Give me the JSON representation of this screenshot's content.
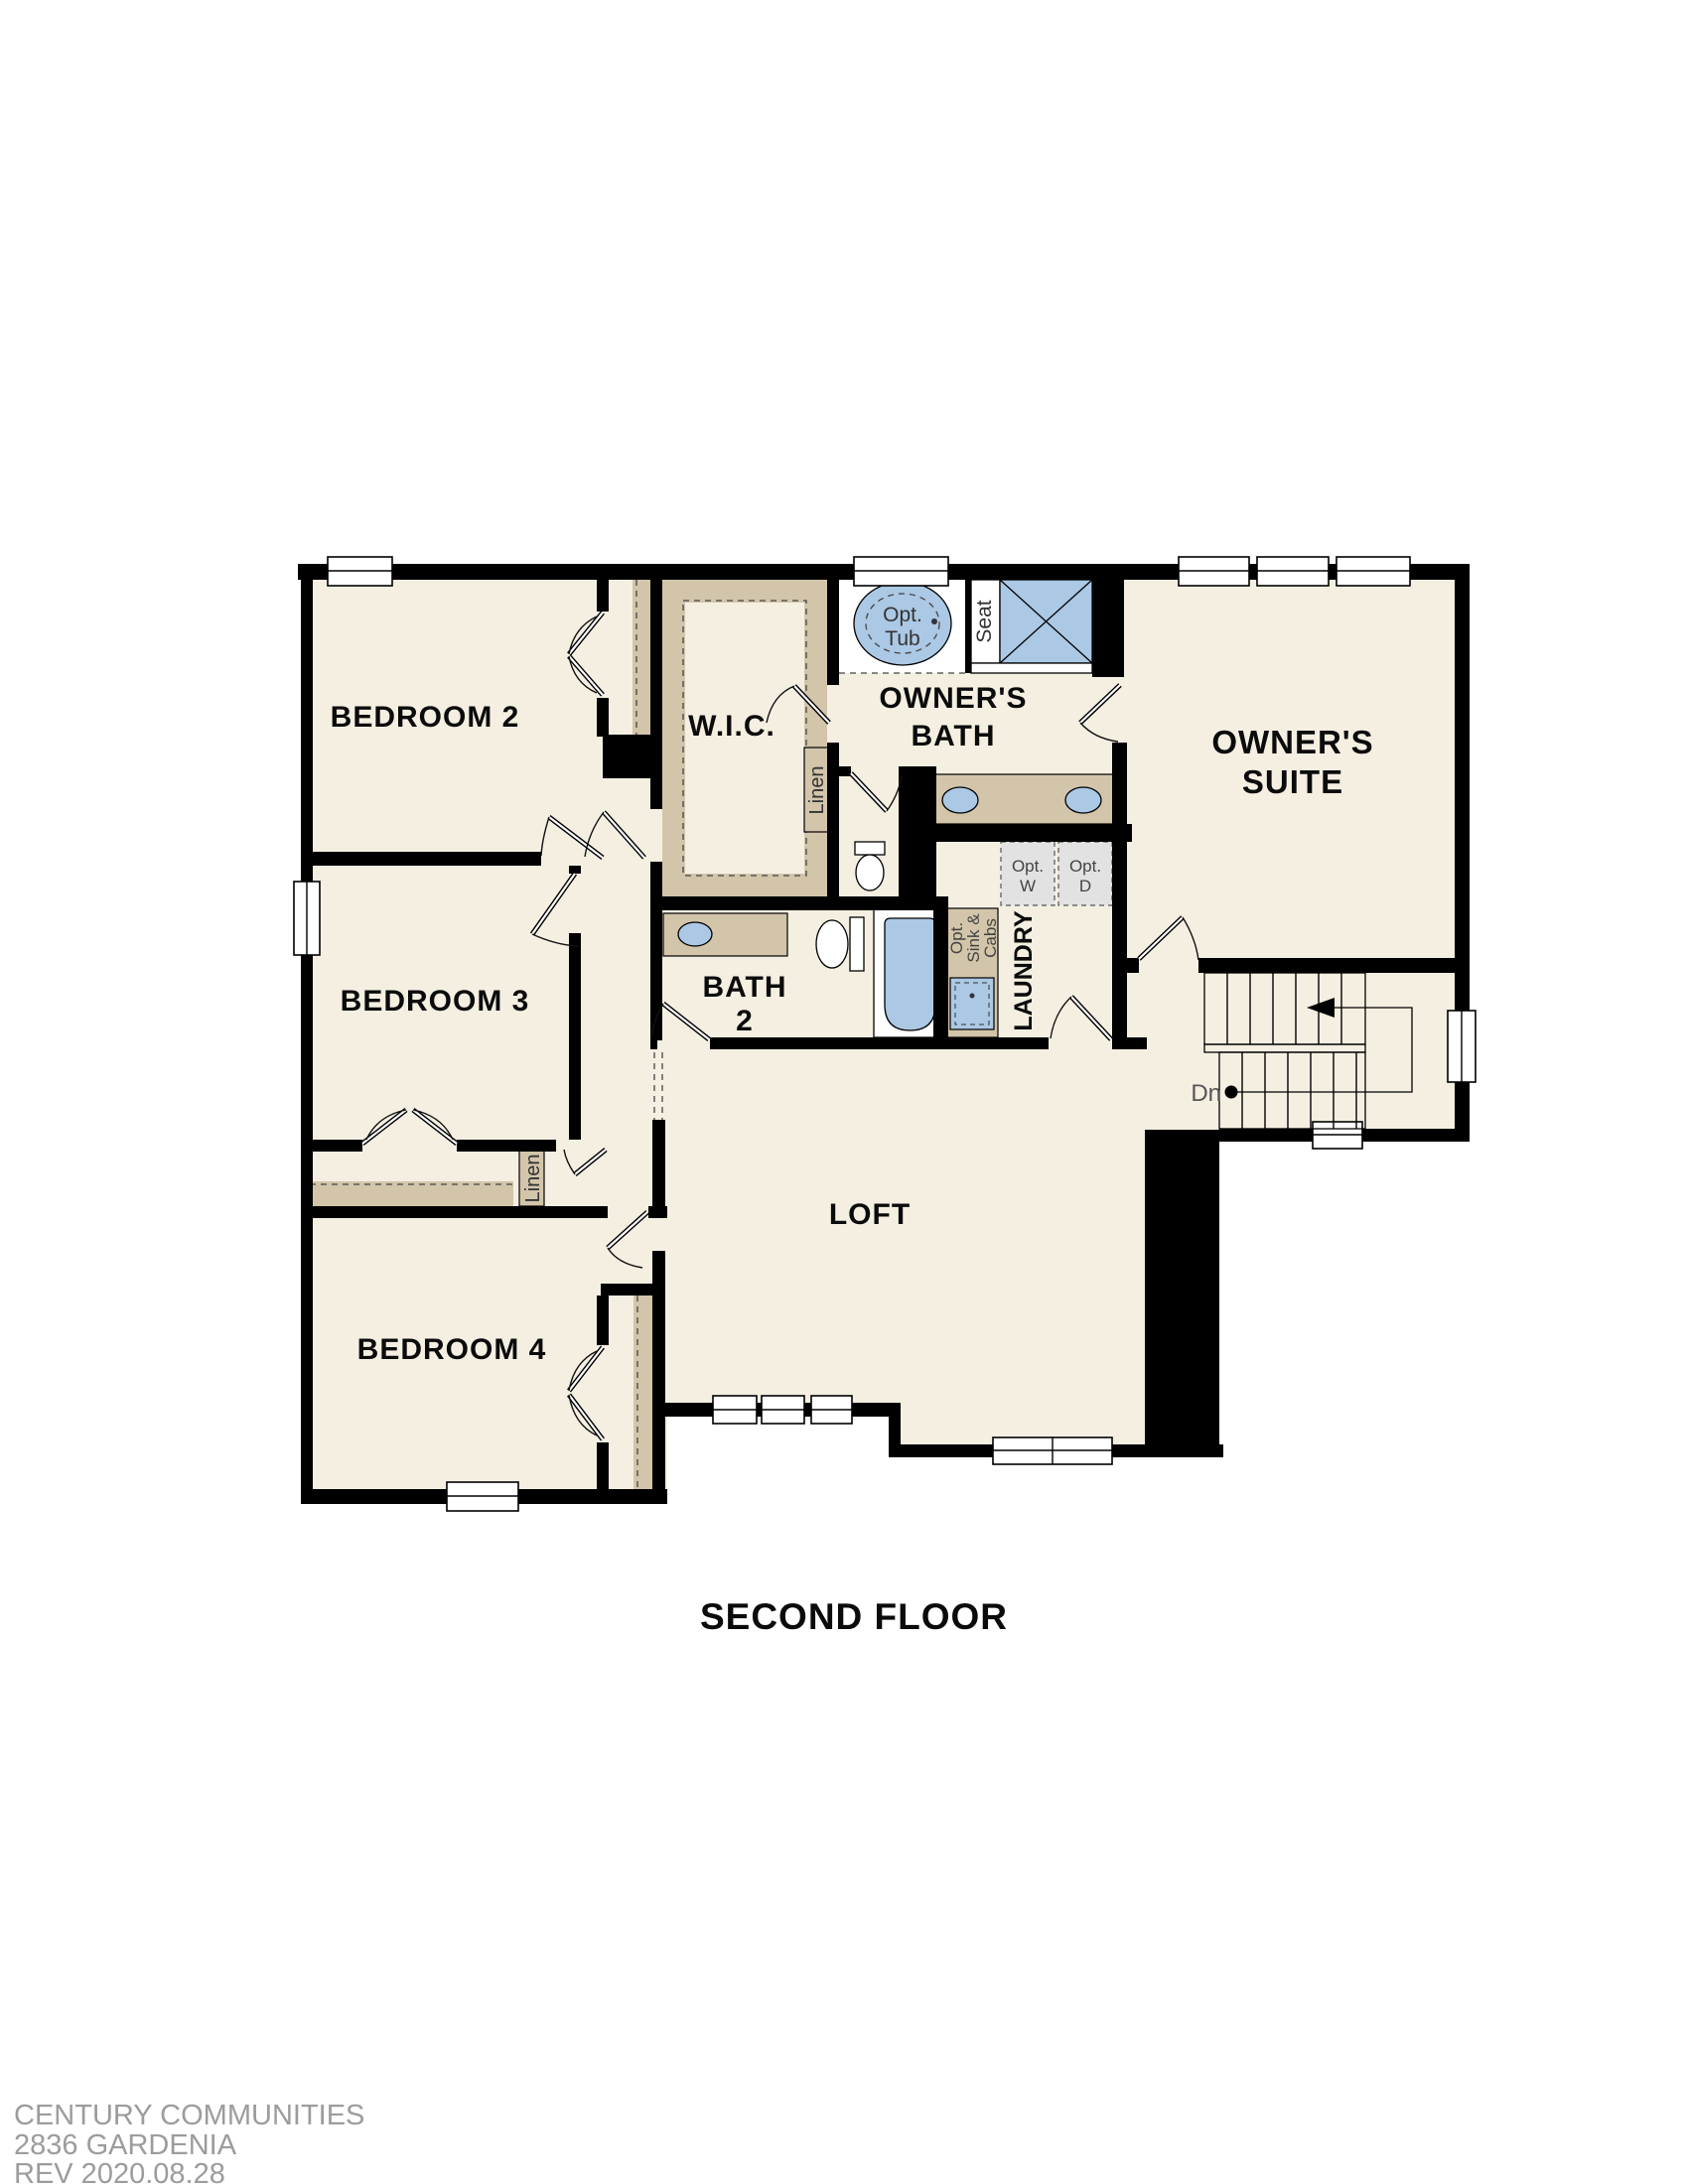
{
  "plan_title": "SECOND FLOOR",
  "rooms": {
    "bedroom2": "BEDROOM 2",
    "bedroom3": "BEDROOM 3",
    "bedroom4": "BEDROOM 4",
    "wic": "W.I.C.",
    "owners_bath_line1": "OWNER'S",
    "owners_bath_line2": "BATH",
    "owners_suite_line1": "OWNER'S",
    "owners_suite_line2": "SUITE",
    "bath2_line1": "BATH",
    "bath2_line2": "2",
    "loft": "LOFT",
    "laundry": "LAUNDRY"
  },
  "fixtures": {
    "opt_tub_line1": "Opt.",
    "opt_tub_line2": "Tub",
    "seat": "Seat",
    "linen_wic": "Linen",
    "linen_hall": "Linen",
    "opt_washer_line1": "Opt.",
    "opt_washer_line2": "W",
    "opt_dryer_line1": "Opt.",
    "opt_dryer_line2": "D",
    "opt_sink_line1": "Opt.",
    "opt_sink_line2": "Sink &",
    "opt_sink_line3": "Cabs",
    "stairs_down": "Dn"
  },
  "footer": {
    "line1": "CENTURY COMMUNITIES",
    "line2": "2836 GARDENIA",
    "line3": "REV 2020.08.28"
  },
  "colors": {
    "floor_beige": "#f5efe2",
    "cabinet_tan": "#d2c5aa",
    "fixture_blue": "#abc8e4",
    "wall_black": "#000000",
    "appliance_gray": "#e2e2e2",
    "footer_gray": "#9c9c9c"
  }
}
